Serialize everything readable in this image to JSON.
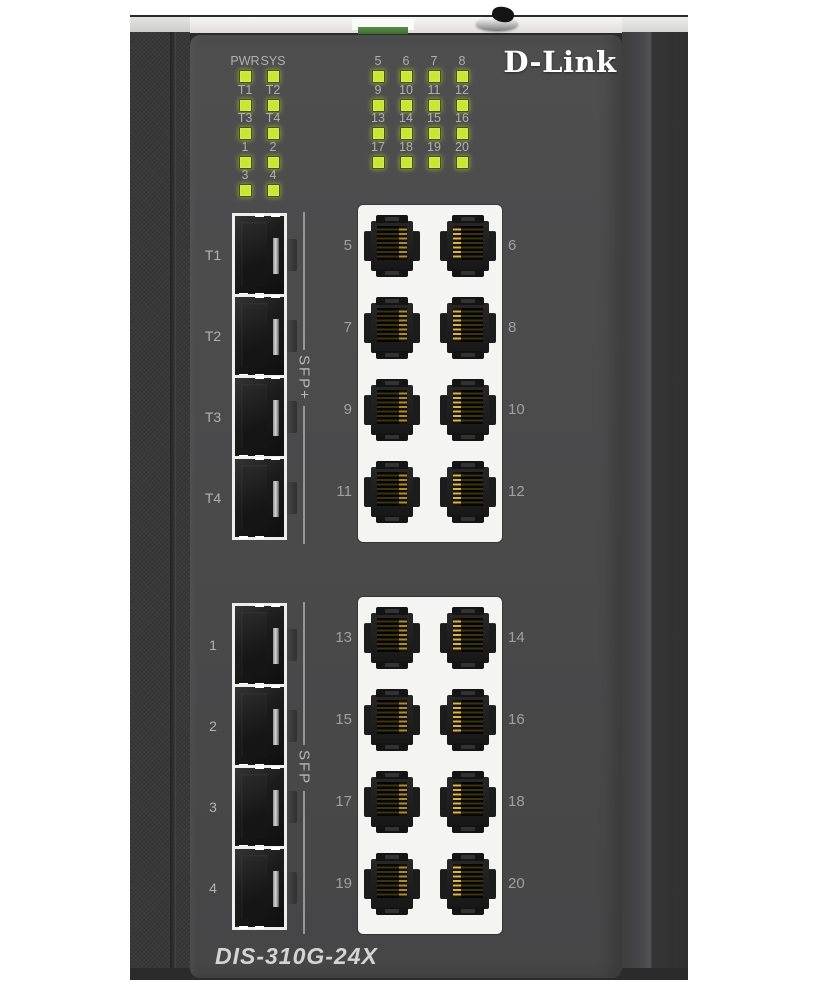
{
  "device": {
    "brand": "D-Link",
    "model": "DIS-310G-24X"
  },
  "led_panel_left": {
    "rows": [
      [
        "PWR",
        "SYS"
      ],
      [
        "T1",
        "T2"
      ],
      [
        "T3",
        "T4"
      ],
      [
        "1",
        "2"
      ],
      [
        "3",
        "4"
      ]
    ]
  },
  "led_panel_right": {
    "rows": [
      [
        "5",
        "6",
        "7",
        "8"
      ],
      [
        "9",
        "10",
        "11",
        "12"
      ],
      [
        "13",
        "14",
        "15",
        "16"
      ],
      [
        "17",
        "18",
        "19",
        "20"
      ]
    ]
  },
  "sfp_plus_group": {
    "label": "SFP+",
    "ports": [
      "T1",
      "T2",
      "T3",
      "T4"
    ]
  },
  "sfp_group": {
    "label": "SFP",
    "ports": [
      "1",
      "2",
      "3",
      "4"
    ]
  },
  "rj45_top": {
    "left": [
      "5",
      "7",
      "9",
      "11"
    ],
    "right": [
      "6",
      "8",
      "10",
      "12"
    ]
  },
  "rj45_bottom": {
    "left": [
      "13",
      "15",
      "17",
      "19"
    ],
    "right": [
      "14",
      "16",
      "18",
      "20"
    ]
  },
  "colors": {
    "led_on": "#c9e632",
    "chassis_face": "#4b4b4c",
    "port_panel": "#f4f4f2",
    "logo_text": "#ffffff"
  }
}
